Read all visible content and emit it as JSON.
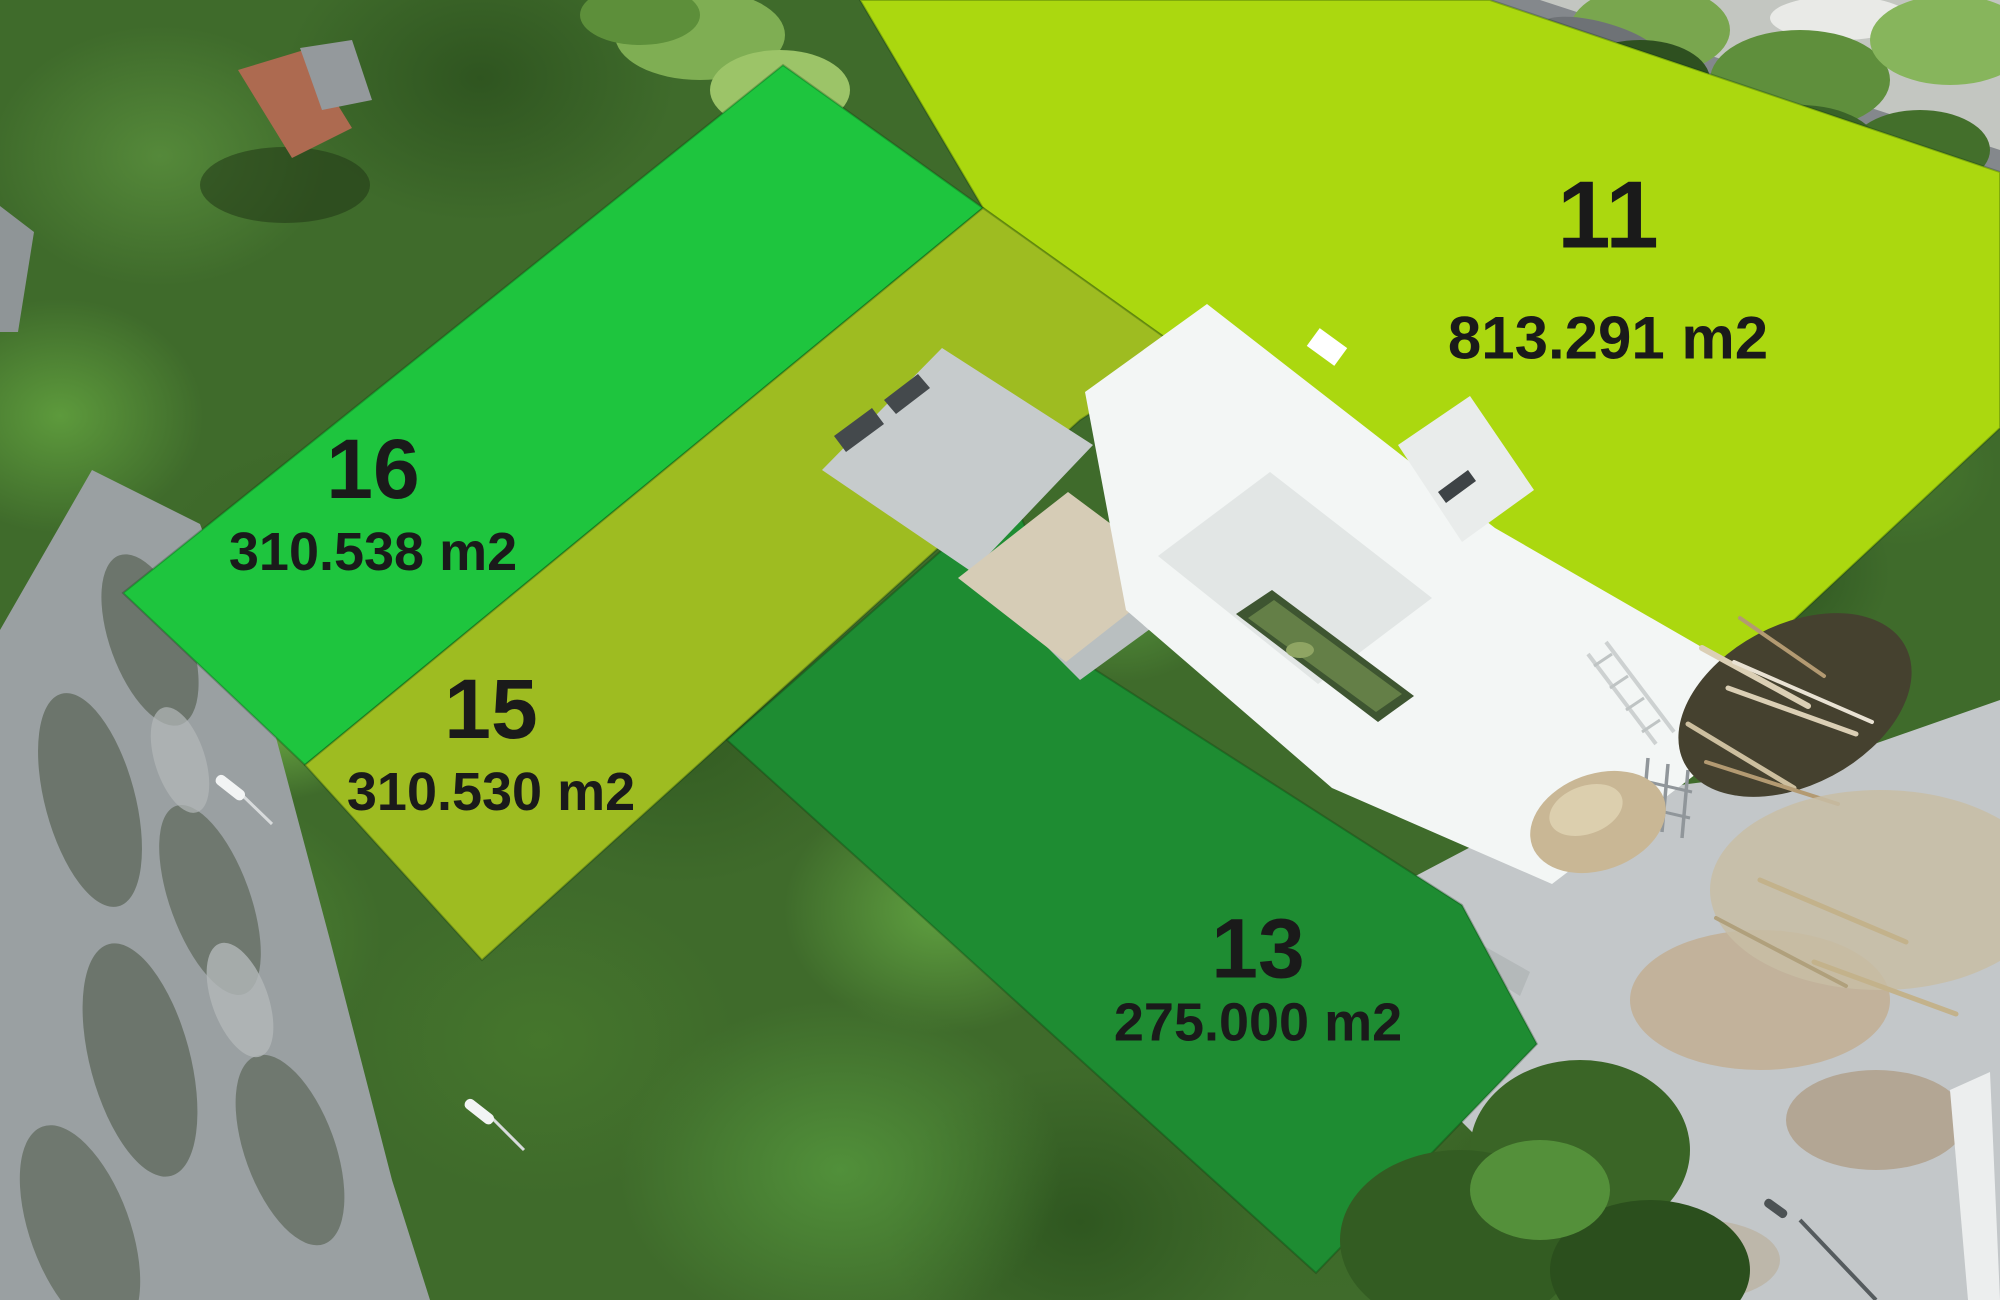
{
  "map": {
    "description_label": "aerial lot map overlay",
    "label_text_color": "#1a1a1a"
  },
  "lots": [
    {
      "number": "11",
      "area_label": "813.291 m2",
      "color": "#abd80f",
      "points": "860,0 1490,0 2000,172 2000,428 1738,672 1495,532 1207,323 1185,352 983,208"
    },
    {
      "number": "16",
      "area_label": "310.538 m2",
      "color": "#1ec53e",
      "points": "783,65 983,208 305,765 123,593"
    },
    {
      "number": "15",
      "area_label": "310.530 m2",
      "color": "#9ebc21",
      "points": "983,208 1185,352 1080,420 482,960 305,765"
    },
    {
      "number": "13",
      "area_label": "275.000 m2",
      "color": "#1e8c32",
      "points": "727,740 1010,490 1080,660 1462,905 1537,1044 1316,1273"
    }
  ]
}
